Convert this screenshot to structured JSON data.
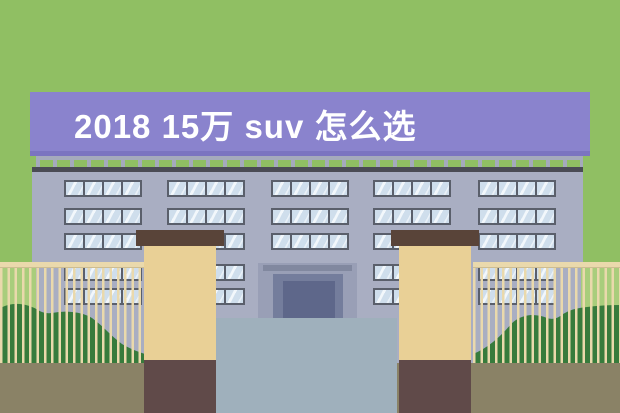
{
  "sign": {
    "title": "2018 15万 suv 怎么选"
  },
  "colors": {
    "bg-green": "#90bf63",
    "light-green": "#a9cd7c",
    "sign-purple": "#8a83cd",
    "sign-shadow": "#7b74c0",
    "facade": "#a9aec2",
    "roof-dark": "#4a4b54",
    "railing": "#a5aabc",
    "window-frame": "#5a5f6b",
    "window-pane": "#cfdeec",
    "porch": "#999fb6",
    "lintel": "#81889f",
    "door-outer": "#747d9c",
    "door-inner": "#5e678a",
    "driveway": "#9fb0bc",
    "pillar-cap": "#594439",
    "pillar-body": "#e9d096",
    "pillar-base": "#604a49",
    "fence": "#ead9ac",
    "bush-green": "#377b3c",
    "ground": "#8a8266"
  }
}
